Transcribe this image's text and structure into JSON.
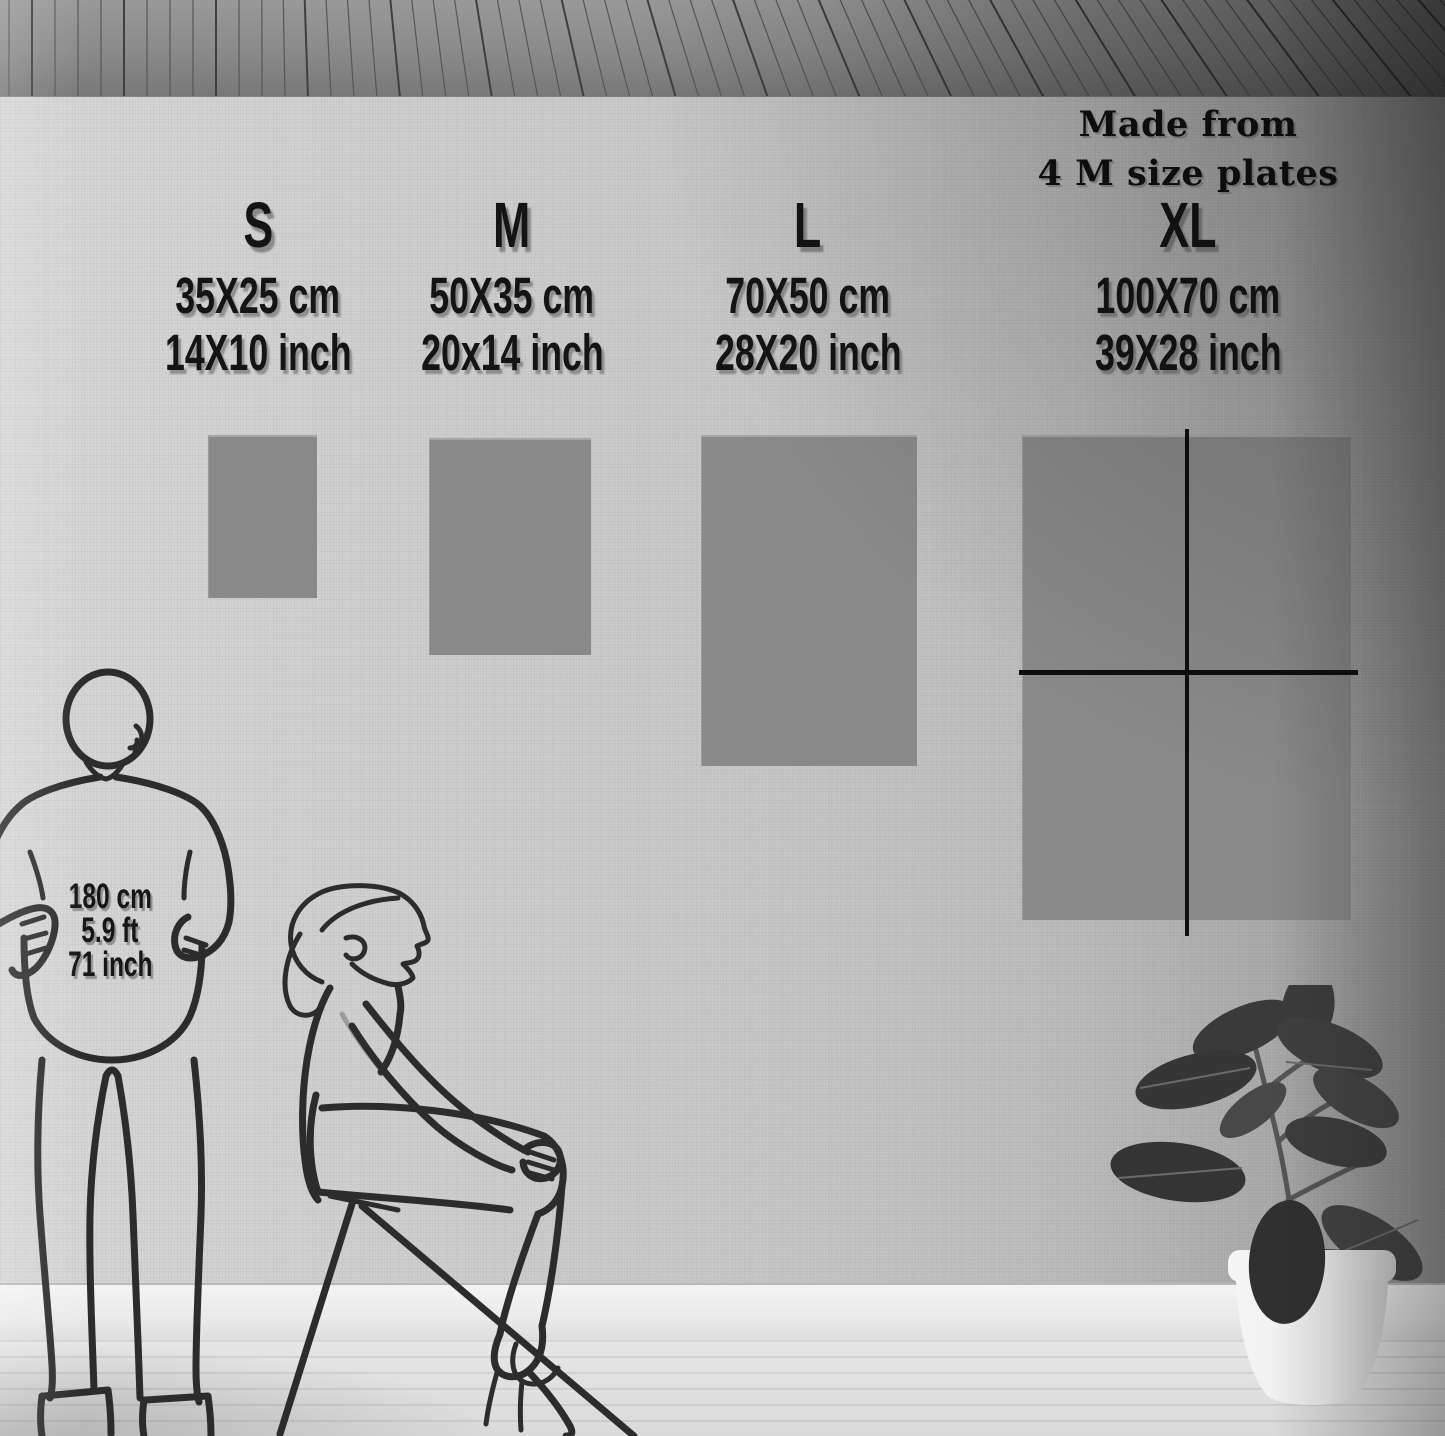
{
  "note": {
    "line1": "Made from",
    "line2": "4 M size plates"
  },
  "columns": [
    {
      "id": "s",
      "label": "S",
      "cm": "35X25 cm",
      "inch": "14X10 inch"
    },
    {
      "id": "m",
      "label": "M",
      "cm": "50X35 cm",
      "inch": "20x14 inch"
    },
    {
      "id": "l",
      "label": "L",
      "cm": "70X50 cm",
      "inch": "28X20 inch"
    },
    {
      "id": "xl",
      "label": "XL",
      "cm": "100X70  cm",
      "inch": "39X28 inch"
    }
  ],
  "reference_height": {
    "cm": "180 cm",
    "ft": "5.9 ft",
    "inch": "71 inch"
  },
  "colors": {
    "poster_gray": "#898989",
    "line_black": "#0e0e0e",
    "text_black": "#141414"
  }
}
